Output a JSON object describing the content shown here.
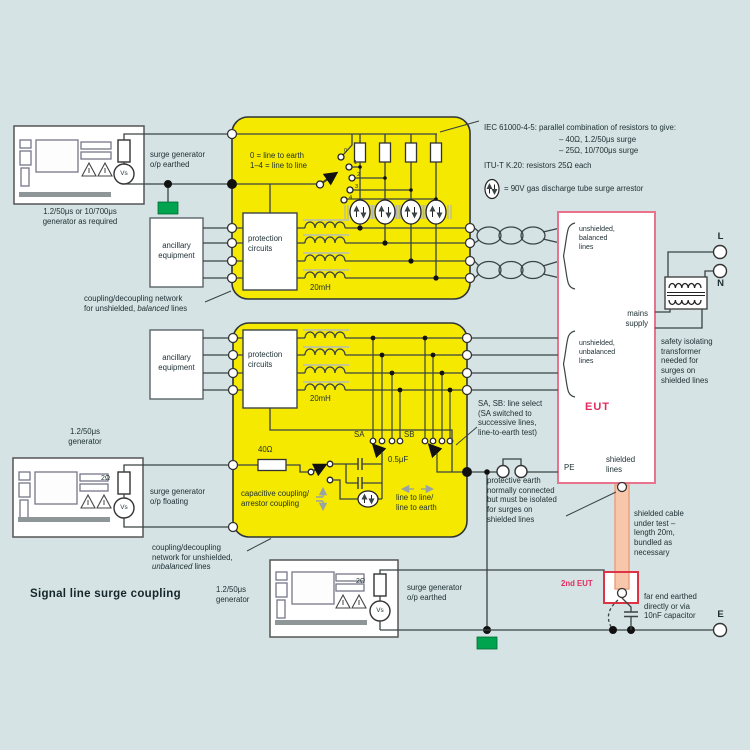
{
  "title": "Signal line surge coupling",
  "generators": {
    "gen1": {
      "name": "1.2/50μs or 10/700μs\ngenerator as required",
      "note": "surge generator\no/p earthed",
      "vs": "Vs"
    },
    "gen2": {
      "name": "1.2/50μs\ngenerator",
      "note": "surge generator\no/p floating",
      "vs": "Vs",
      "resistor": "2Ω"
    },
    "gen3": {
      "name": "1.2/50μs\ngenerator",
      "note": "surge generator\no/p earthed",
      "vs": "Vs",
      "resistor": "2Ω"
    }
  },
  "cdn1": {
    "selector_note": "0 = line to earth\n1–4 = line to line",
    "positions": [
      "0",
      "1",
      "2",
      "3",
      "4"
    ],
    "inductance": "20mH",
    "protection": "protection\ncircuits",
    "ancillary": "ancillary\nequipment",
    "caption_pre": "coupling/decoupling network\nfor unshielded, ",
    "caption_em": "balanced",
    "caption_post": " lines"
  },
  "cdn2": {
    "inductance": "20mH",
    "protection": "protection\ncircuits",
    "ancillary": "ancillary\nequipment",
    "resistor": "40Ω",
    "capacitor": "0.5μF",
    "sa": "SA",
    "sb": "SB",
    "coupling_note": "capacitive coupling/\narrestor coupling",
    "line_select_note": "line to line/\nline to earth",
    "caption_pre": "coupling/decoupling\nnetwork for unshielded,\n",
    "caption_em": "unbalanced",
    "caption_post": " lines"
  },
  "legend": {
    "iec_line1": "IEC 61000-4-5: parallel combination of resistors to give:",
    "iec_item1": "– 40Ω, 1.2/50μs surge",
    "iec_item2": "– 25Ω, 10/700μs surge",
    "itu_line": "ITU-T K.20: resistors 25Ω each",
    "gdt_line": "= 90V gas discharge tube surge arrestor"
  },
  "eut": {
    "label": "EUT",
    "pe": "PE",
    "shielded": "shielded\nlines",
    "balanced": "unshielded,\nbalanced\nlines",
    "unbalanced": "unshielded,\nunbalanced\nlines",
    "mains": "mains\nsupply"
  },
  "mains": {
    "l": "L",
    "n": "N",
    "e": "E",
    "transformer_note": "safety isolating\ntransformer\nneeded for\nsurges on\nshielded lines"
  },
  "notes": {
    "sa_sb": "SA, SB: line select\n(SA switched to\nsuccessive lines,\nline-to-earth test)",
    "protective_earth": "protective earth\nnormally connected\nbut must be isolated\nfor surges on\nshielded lines",
    "cable": "shielded cable\nunder test –\nlength 20m,\nbundled as\nnecessary",
    "far_end": "far end earthed\ndirectly or via\n10nF capacitor",
    "second_eut": "2nd EUT"
  },
  "colors": {
    "background": "#d5e3e4",
    "cdn_yellow": "#f5e900",
    "eut_border_pink": "#e9738d",
    "accent_red": "#e42a5e",
    "second_eut_border": "#dd3344",
    "earth_green": "#00a44f",
    "cable_salmon": "#f7c6ab",
    "wire": "#3a4345"
  }
}
